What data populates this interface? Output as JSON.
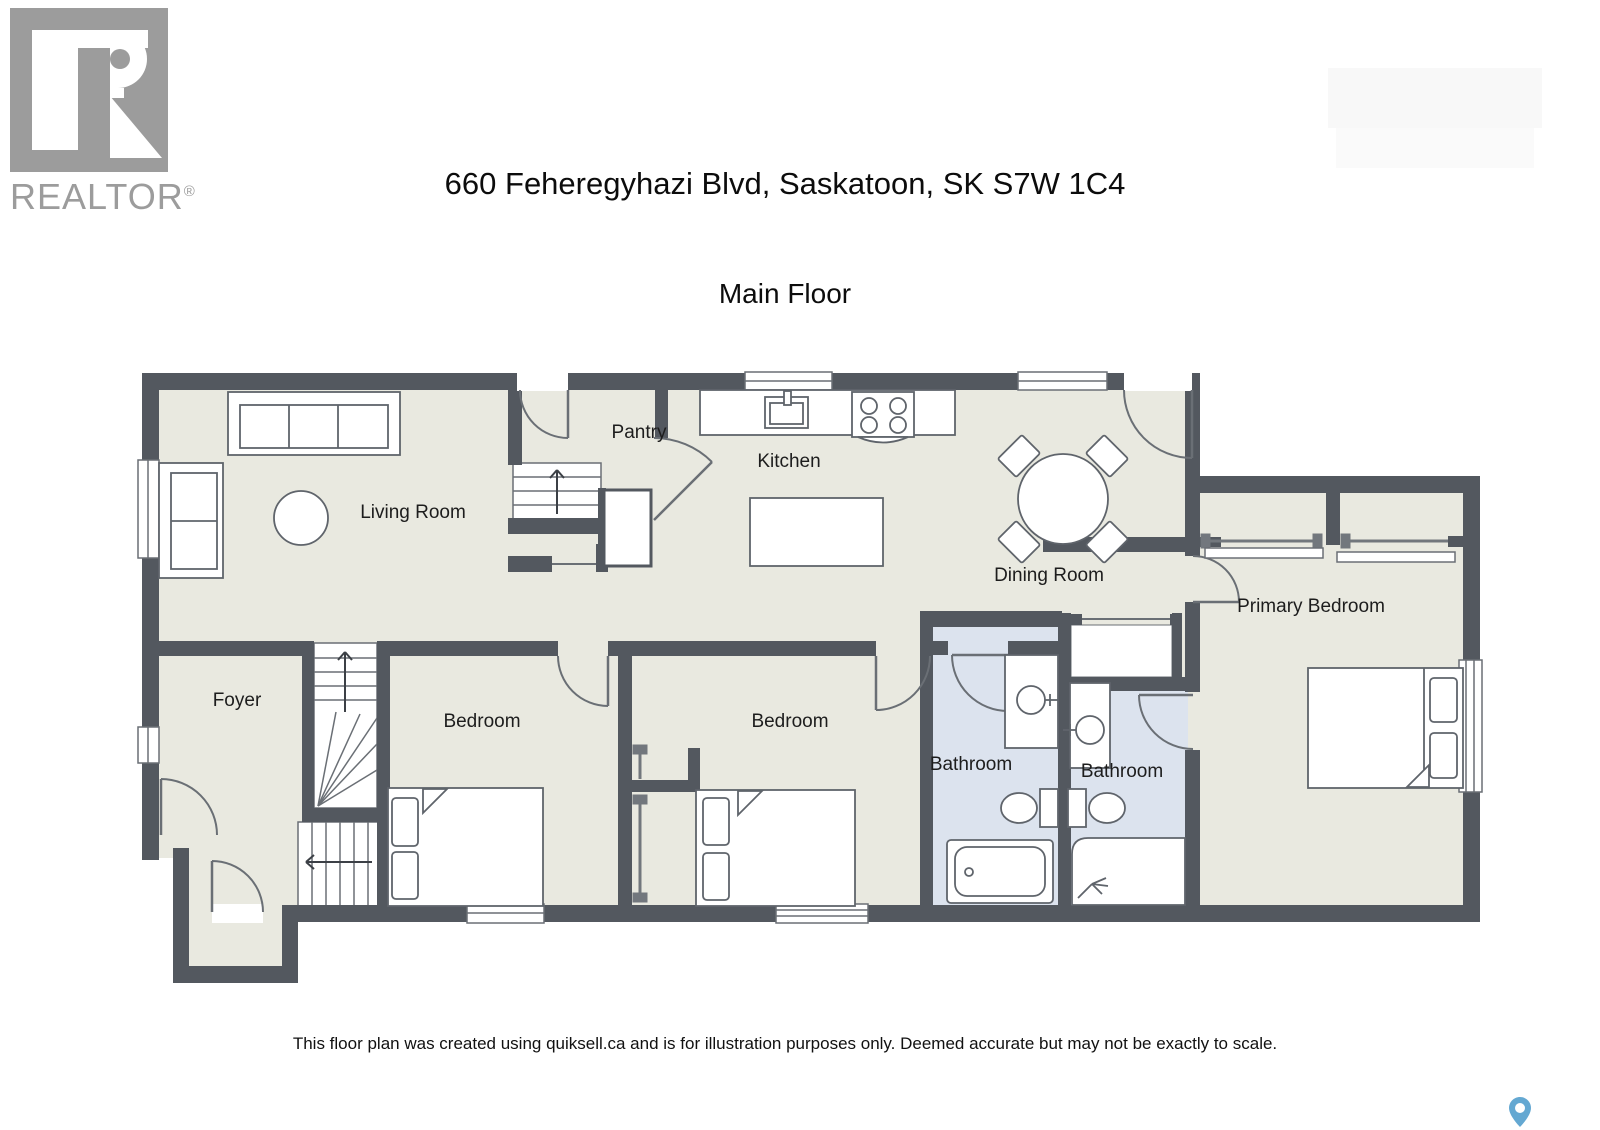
{
  "branding": {
    "logo_text": "REALTOR",
    "logo_mark": "®",
    "logo_icon": "realtor-r-icon"
  },
  "header": {
    "title": "660 Feheregyhazi Blvd, Saskatoon, SK S7W 1C4",
    "subtitle": "Main Floor"
  },
  "floor_plan": {
    "rooms": {
      "living_room": {
        "label": "Living Room"
      },
      "pantry": {
        "label": "Pantry"
      },
      "kitchen": {
        "label": "Kitchen"
      },
      "dining_room": {
        "label": "Dining Room"
      },
      "primary_bedroom": {
        "label": "Primary Bedroom"
      },
      "foyer": {
        "label": "Foyer"
      },
      "bedroom_left": {
        "label": "Bedroom"
      },
      "bedroom_middle": {
        "label": "Bedroom"
      },
      "bathroom_main": {
        "label": "Bathroom"
      },
      "bathroom_ensuite": {
        "label": "Bathroom"
      }
    },
    "icons": [
      "sofa-icon",
      "loveseat-icon",
      "round-table-icon",
      "stairs-up-icon",
      "winding-stairs-icon",
      "kitchen-counter-icon",
      "kitchen-sink-icon",
      "stove-icon",
      "kitchen-island-icon",
      "dining-table-icon",
      "dining-chair-icon",
      "bed-icon",
      "pillow-icon",
      "toilet-icon",
      "vanity-sink-icon",
      "bathtub-icon",
      "shower-icon",
      "closet-rod-icon",
      "door-swing-icon",
      "window-icon",
      "map-pin-icon",
      "realtor-r-icon"
    ]
  },
  "footer": {
    "disclaimer": "This floor plan was created using quiksell.ca and is for illustration purposes only. Deemed accurate but may not be exactly to scale."
  },
  "colors": {
    "wall": "#53585f",
    "floor": "#e9e9e0",
    "bathroom_floor": "#dce3ee",
    "furniture_outline": "#5f646b",
    "thin_line": "#6a6f75",
    "logo_gray": "#9c9c9c",
    "pin_blue": "#64a8d2",
    "text": "#1c1c1c"
  }
}
